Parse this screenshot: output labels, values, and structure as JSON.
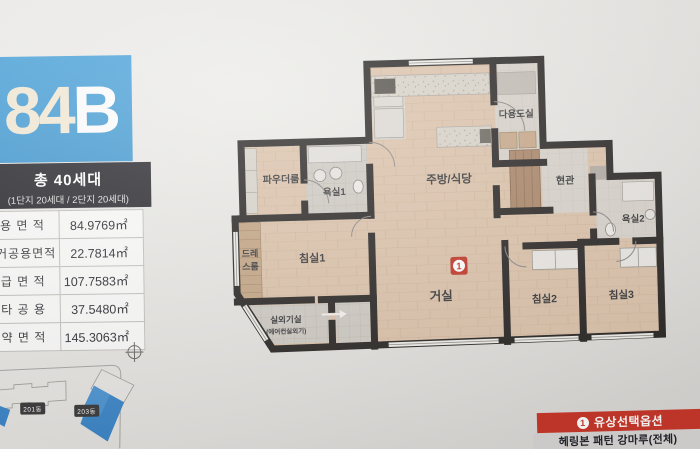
{
  "header": {
    "unit_number": "84",
    "unit_letter": "B",
    "total_units": "총 40세대",
    "units_breakdown": "(1단지 20세대 / 2단지 20세대)"
  },
  "area_table": {
    "rows": [
      {
        "label": "전 용 면 적",
        "value": "84.9769㎡"
      },
      {
        "label": "주거공용면적",
        "value": "22.7814㎡"
      },
      {
        "label": "공 급 면 적",
        "value": "107.7583㎡"
      },
      {
        "label": "기 타 공 용",
        "value": "37.5480㎡"
      },
      {
        "label": "계 약 면 적",
        "value": "145.3063㎡"
      }
    ]
  },
  "site_plan": {
    "buildings": [
      "201동",
      "203동"
    ]
  },
  "floor_plan": {
    "rooms": {
      "kitchen": "주방/식당",
      "utility": "다용도실",
      "entrance": "현관",
      "bath2": "욕실2",
      "powder": "파우더룸",
      "bath1": "욕실1",
      "dress_line1": "드레",
      "dress_line2": "스룸",
      "bed1": "침실1",
      "living": "거실",
      "bed2": "침실2",
      "bed3": "침실3",
      "ac_room": "실외기실",
      "ac_room_sub": "(에어컨실외기)"
    },
    "option_badge": "1"
  },
  "option_box": {
    "badge": "1",
    "title": "유상선택옵션",
    "subtitle": "헤링본 패턴 강마루(전체)"
  },
  "colors": {
    "accent_blue": "#4ba3db",
    "band_dark": "#2a2a30",
    "option_red": "#c9382a",
    "wall": "#2a2725",
    "wood_floor": "#dcc3ab",
    "site_building_blue": "#3e87c8"
  }
}
